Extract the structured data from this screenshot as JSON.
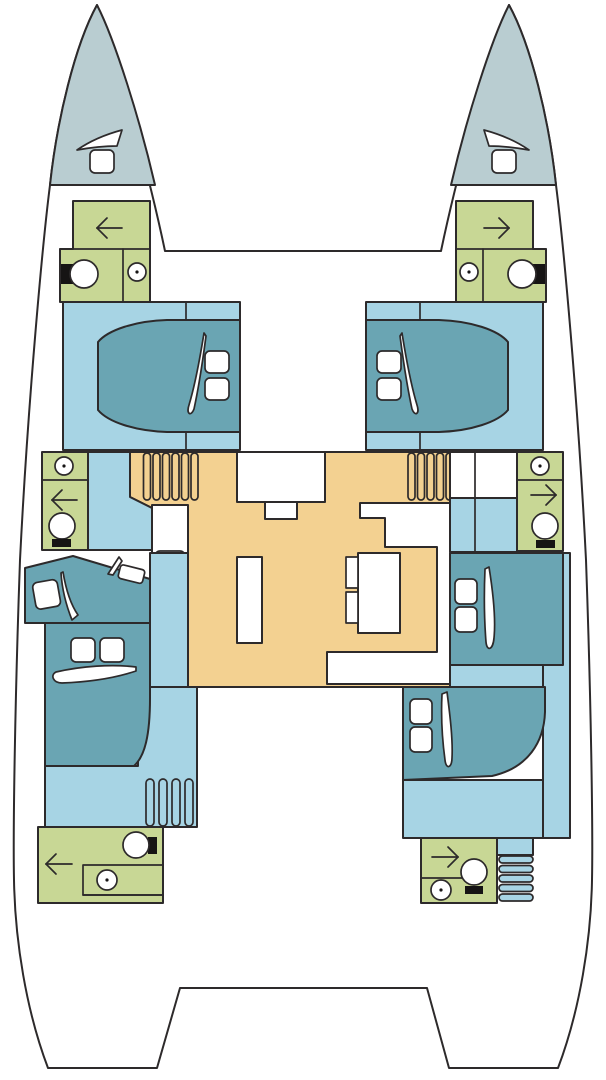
{
  "figure": {
    "kind": "catamaran-deck-plan",
    "view": "top-down interior layout, bows up, twin hulls joined by central saloon"
  },
  "colors": {
    "page_bg": "#ffffff",
    "outline": "#2d2a2b",
    "hull_white": "#ffffff",
    "bow_deck": "#b9cdd1",
    "bathroom_green": "#c8d795",
    "floor_blue": "#a7d4e4",
    "berth_teal": "#6aa5b3",
    "saloon_sand": "#f3d191",
    "fixture_dark": "#161414"
  },
  "icons": {
    "toilet": "ellipse-with-dark-tank",
    "sink": "circle-with-center-dot",
    "stove": "four-burner-grid",
    "galley_sink": "rounded-rect-basin",
    "door_swing": "slender-white-wedge",
    "steps": "striped-bars",
    "entry_arrow": "open-head-arrow",
    "hatch": "rounded-white-square"
  },
  "rooms": {
    "port_bow": "forepeak deck",
    "starboard_bow": "forepeak deck",
    "port_forward_head": "bathroom",
    "starboard_forward_head": "bathroom",
    "port_forward_cabin": "double berth cabin",
    "starboard_forward_cabin": "double berth cabin",
    "saloon": "galley, island, entry, U-settee with table",
    "port_mid_head": "bathroom",
    "starboard_mid_head": "bathroom",
    "port_aft_cabins": "two berths",
    "starboard_aft_cabins": "two berths",
    "port_aft_head": "bathroom",
    "starboard_aft_head": "bathroom",
    "cockpit": "open aft deck"
  }
}
